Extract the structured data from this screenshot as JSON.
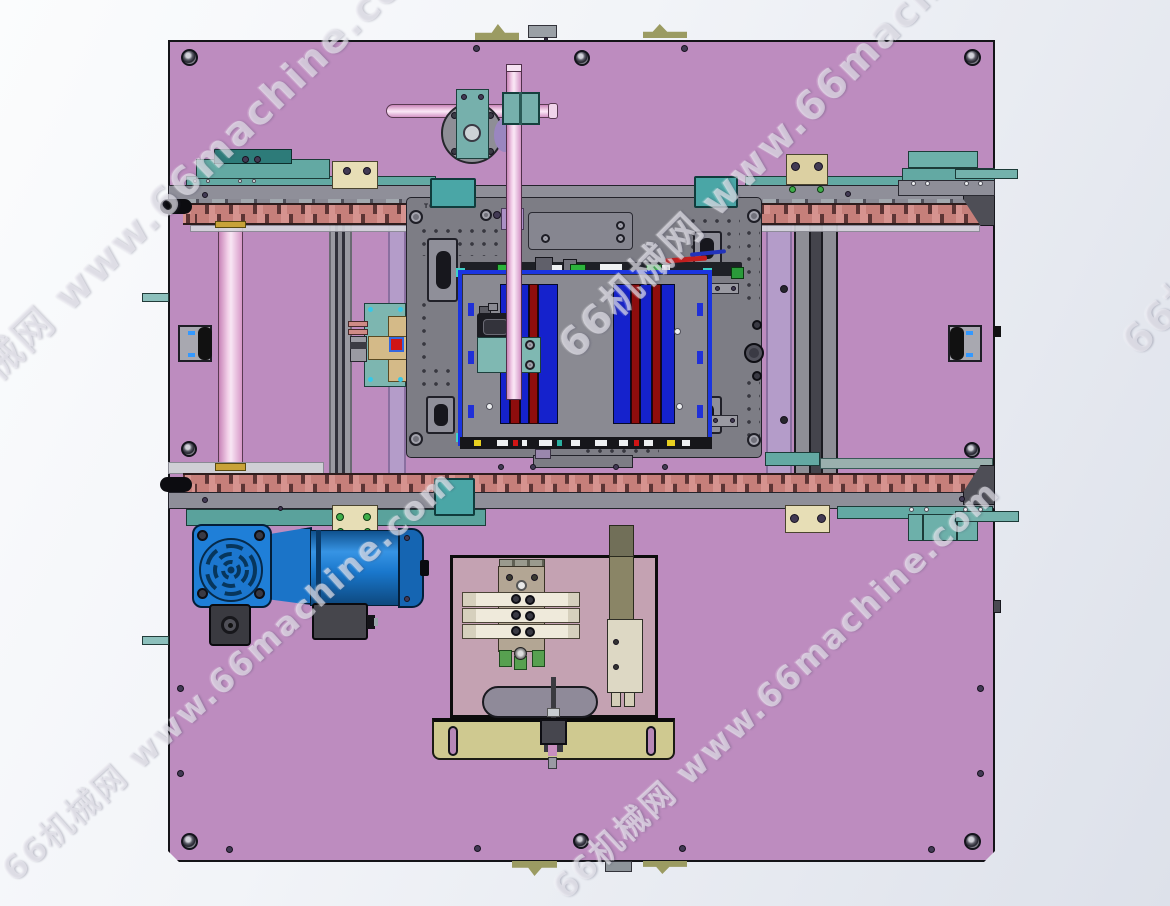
{
  "watermark": {
    "text": "66机械网 www.66machine.com",
    "instances": [
      {
        "x": 5,
        "y": 872,
        "angle": -42,
        "size": 33
      },
      {
        "x": 556,
        "y": 890,
        "angle": -43,
        "size": 33
      },
      {
        "x": 563,
        "y": 348,
        "angle": -45,
        "size": 40
      },
      {
        "x": -88,
        "y": 440,
        "angle": -44,
        "size": 40
      },
      {
        "x": 1126,
        "y": 345,
        "angle": -45,
        "size": 40
      }
    ]
  },
  "labels": {
    "fixture_part": "T00"
  },
  "palette": {
    "base_plate": "#bd8cbf",
    "fixture_plate": "#7d7d85",
    "rail_gray": "#8f8f99",
    "chain_pink": "#cf8b86",
    "teal": "#5aa29c",
    "motor_blue": "#1f7fd8",
    "carrier_blue": "#1522cc",
    "carrier_red": "#8e0d0d",
    "rod_pink": "#f4d2ea",
    "lavender": "#b49cc9",
    "frame_blue": "#1a35e0",
    "khaki_bracket": "#cfc990",
    "cream_block": "#e7deb6"
  }
}
